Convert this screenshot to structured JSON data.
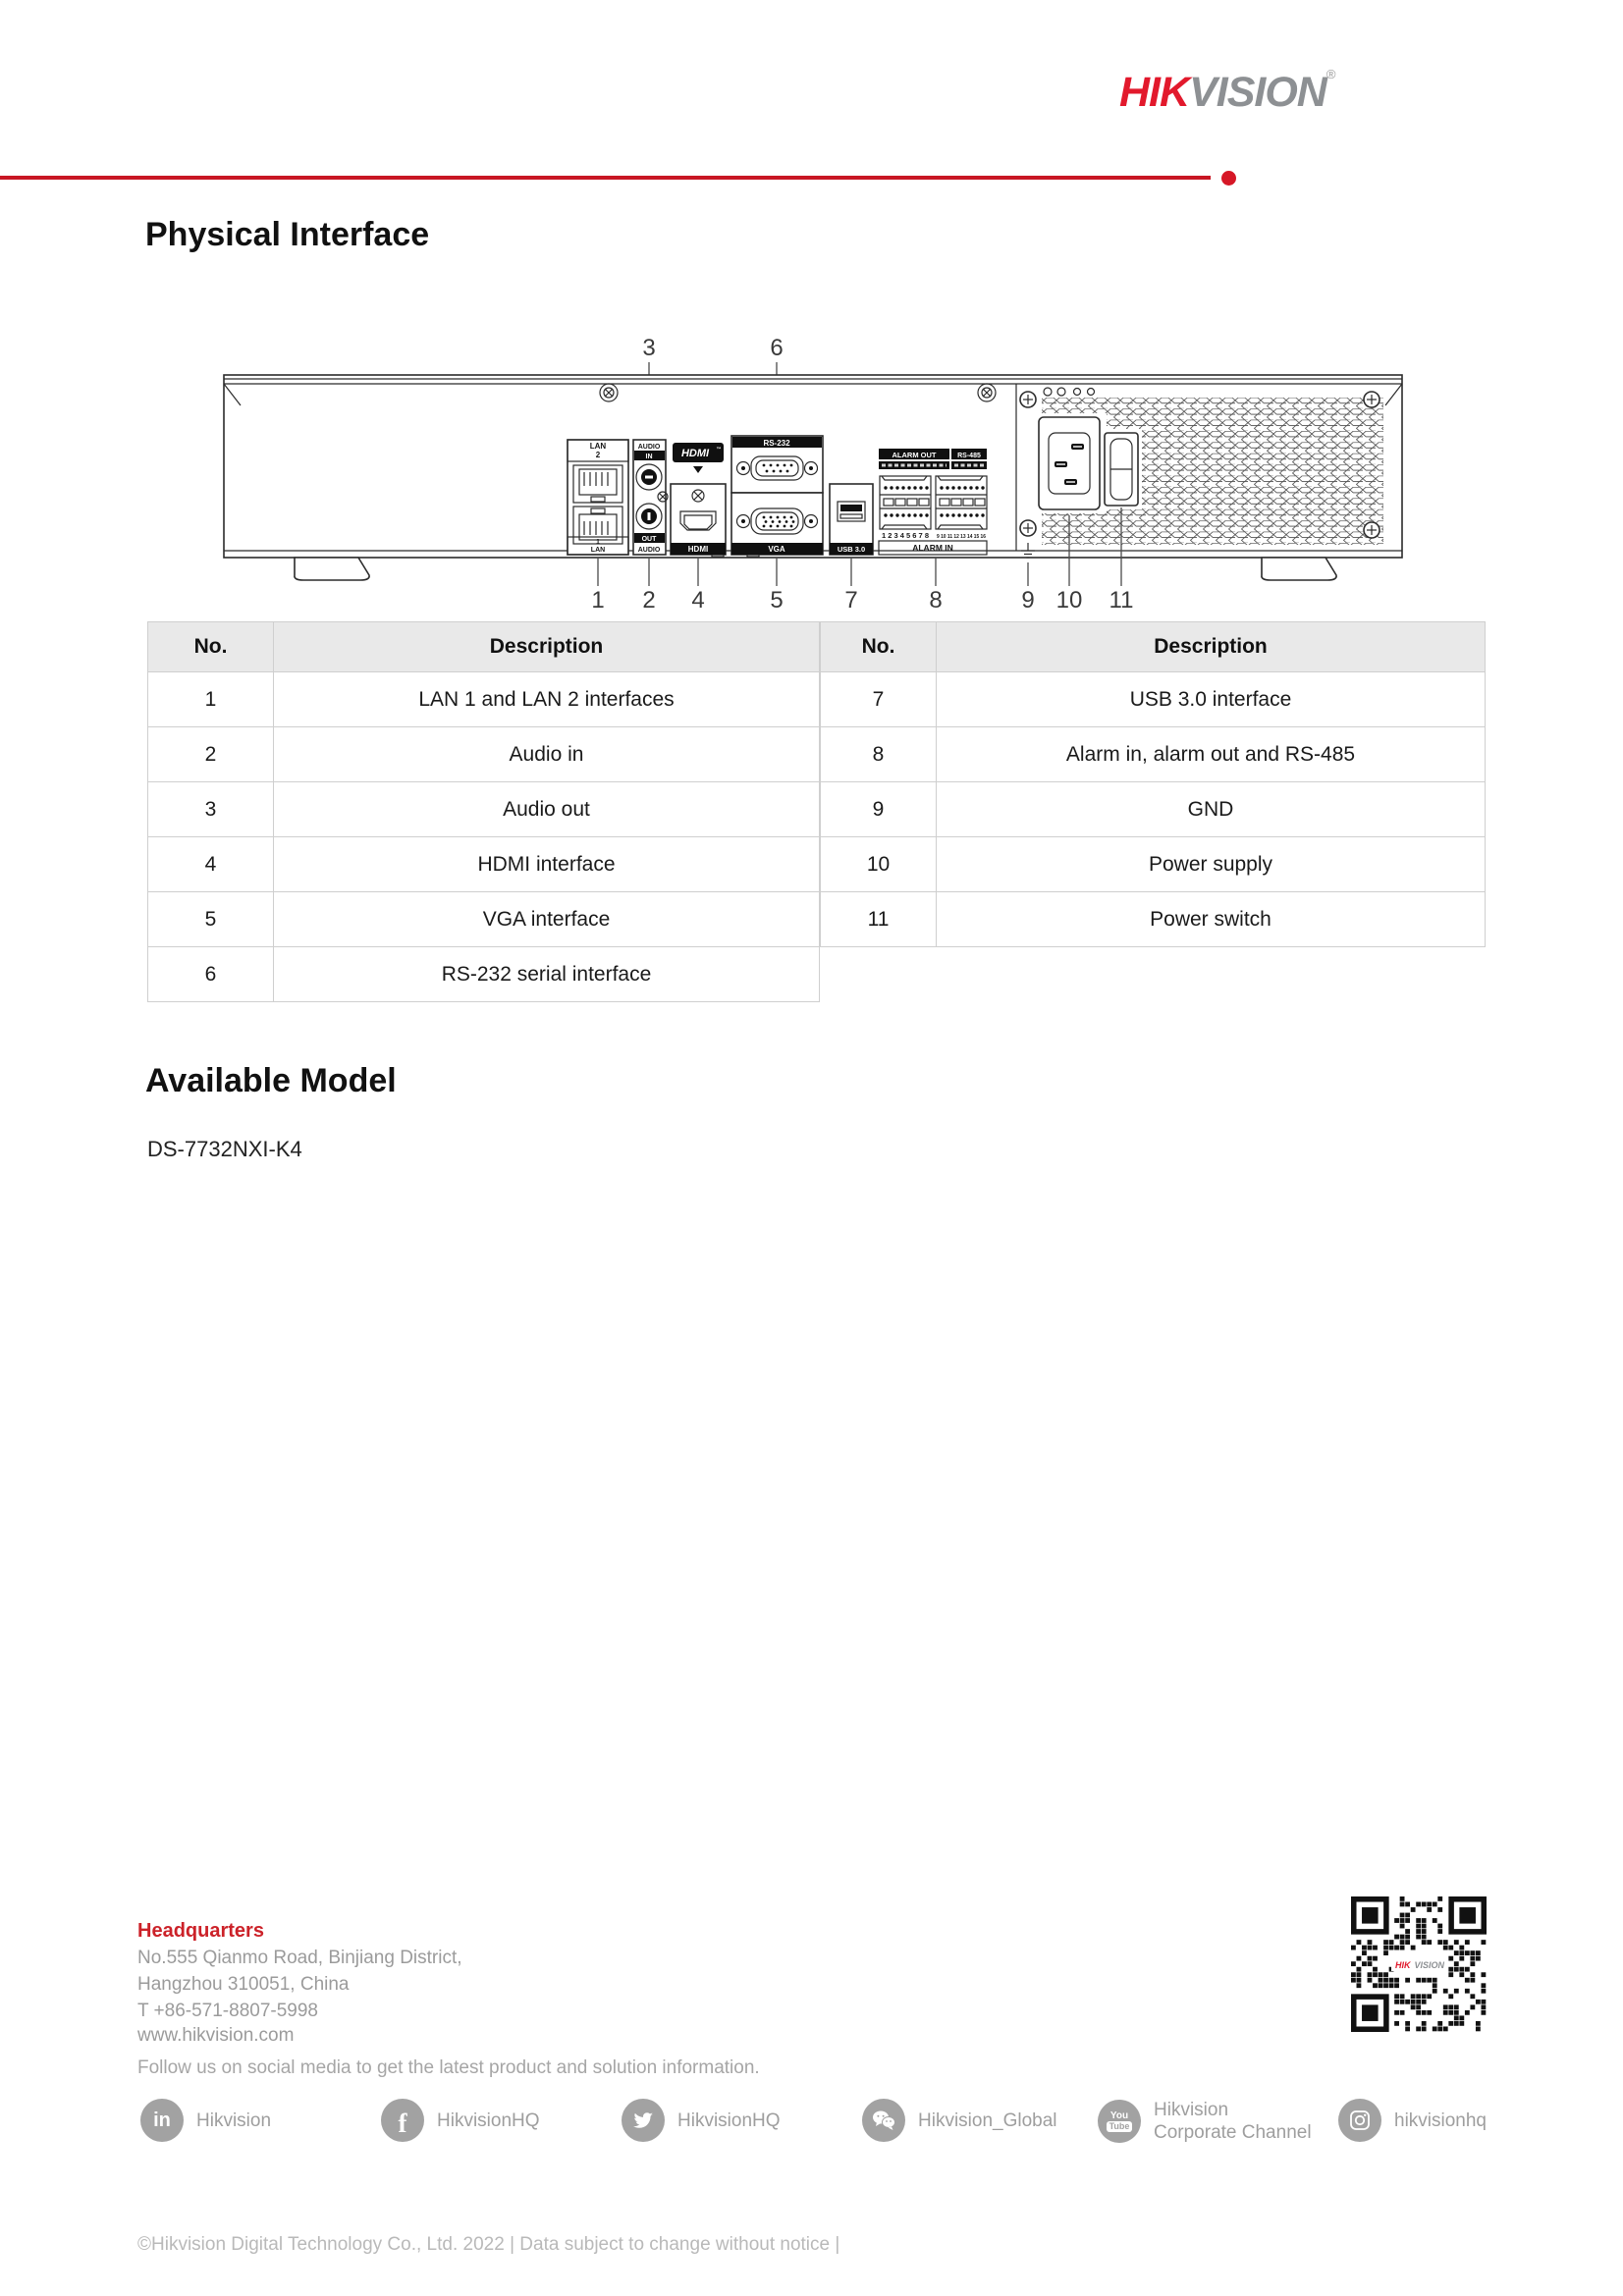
{
  "brand": {
    "logo_hik": "HIK",
    "logo_vision": "VISION",
    "logo_reg": "®",
    "red": "#e2192c",
    "gray": "#8d9093",
    "rule_red": "#c81623"
  },
  "page": {
    "section1_title": "Physical Interface",
    "section2_title": "Available Model",
    "model": "DS-7732NXI-K4"
  },
  "diagram": {
    "callouts_top": [
      "3",
      "6"
    ],
    "callouts_bottom": [
      "1",
      "2",
      "4",
      "5",
      "7",
      "8",
      "9",
      "10",
      "11"
    ],
    "port_labels": {
      "lan_top_line1": "LAN",
      "lan_top_line2": "2",
      "lan_bottom_line1": "1",
      "lan_bottom_line2": "LAN",
      "audio_top": "AUDIO",
      "audio_in": "IN",
      "audio_out": "OUT",
      "audio_bottom": "AUDIO",
      "hdmi_logo": "HDMI",
      "hdmi_tm": "™",
      "hdmi_bar": "HDMI",
      "rs232_bar": "RS-232",
      "vga_bar": "VGA",
      "usb_bar": "USB 3.0",
      "alarm_out_bar": "ALARM OUT",
      "rs485_bar": "RS-485",
      "alarm_in_bar": "ALARM IN",
      "terminals_left": "1 2 3 4 5 6 7 8",
      "terminals_right": "9 10 11 12 13 14 15 16"
    }
  },
  "table": {
    "left": {
      "headers": [
        "No.",
        "Description"
      ],
      "rows": [
        {
          "no": "1",
          "desc": "LAN 1 and LAN 2 interfaces"
        },
        {
          "no": "2",
          "desc": "Audio in"
        },
        {
          "no": "3",
          "desc": "Audio out"
        },
        {
          "no": "4",
          "desc": "HDMI interface"
        },
        {
          "no": "5",
          "desc": "VGA interface"
        },
        {
          "no": "6",
          "desc": "RS-232 serial interface"
        }
      ]
    },
    "right": {
      "headers": [
        "No.",
        "Description"
      ],
      "rows": [
        {
          "no": "7",
          "desc": "USB 3.0 interface"
        },
        {
          "no": "8",
          "desc": "Alarm in, alarm out and RS-485"
        },
        {
          "no": "9",
          "desc": "GND"
        },
        {
          "no": "10",
          "desc": "Power supply"
        },
        {
          "no": "11",
          "desc": "Power switch"
        }
      ]
    }
  },
  "footer": {
    "hq_title": "Headquarters",
    "address1": "No.555 Qianmo Road, Binjiang District,",
    "address2": "Hangzhou 310051, China",
    "phone": "T +86-571-8807-5998",
    "website": "www.hikvision.com",
    "follow": "Follow us on social media to get the latest product and solution information.",
    "social": [
      {
        "icon": "linkedin",
        "glyph": "in",
        "label": "Hikvision"
      },
      {
        "icon": "facebook",
        "glyph": "f",
        "label": "HikvisionHQ"
      },
      {
        "icon": "twitter",
        "label": "HikvisionHQ"
      },
      {
        "icon": "wechat",
        "label": "Hikvision_Global"
      },
      {
        "icon": "youtube",
        "icon_line1": "You",
        "icon_line2": "Tube",
        "label": "Hikvision",
        "label2": "Corporate Channel"
      },
      {
        "icon": "instagram",
        "label": "hikvisionhq"
      }
    ],
    "copyright": "©Hikvision Digital Technology Co., Ltd. 2022 | Data subject to change without notice |"
  }
}
